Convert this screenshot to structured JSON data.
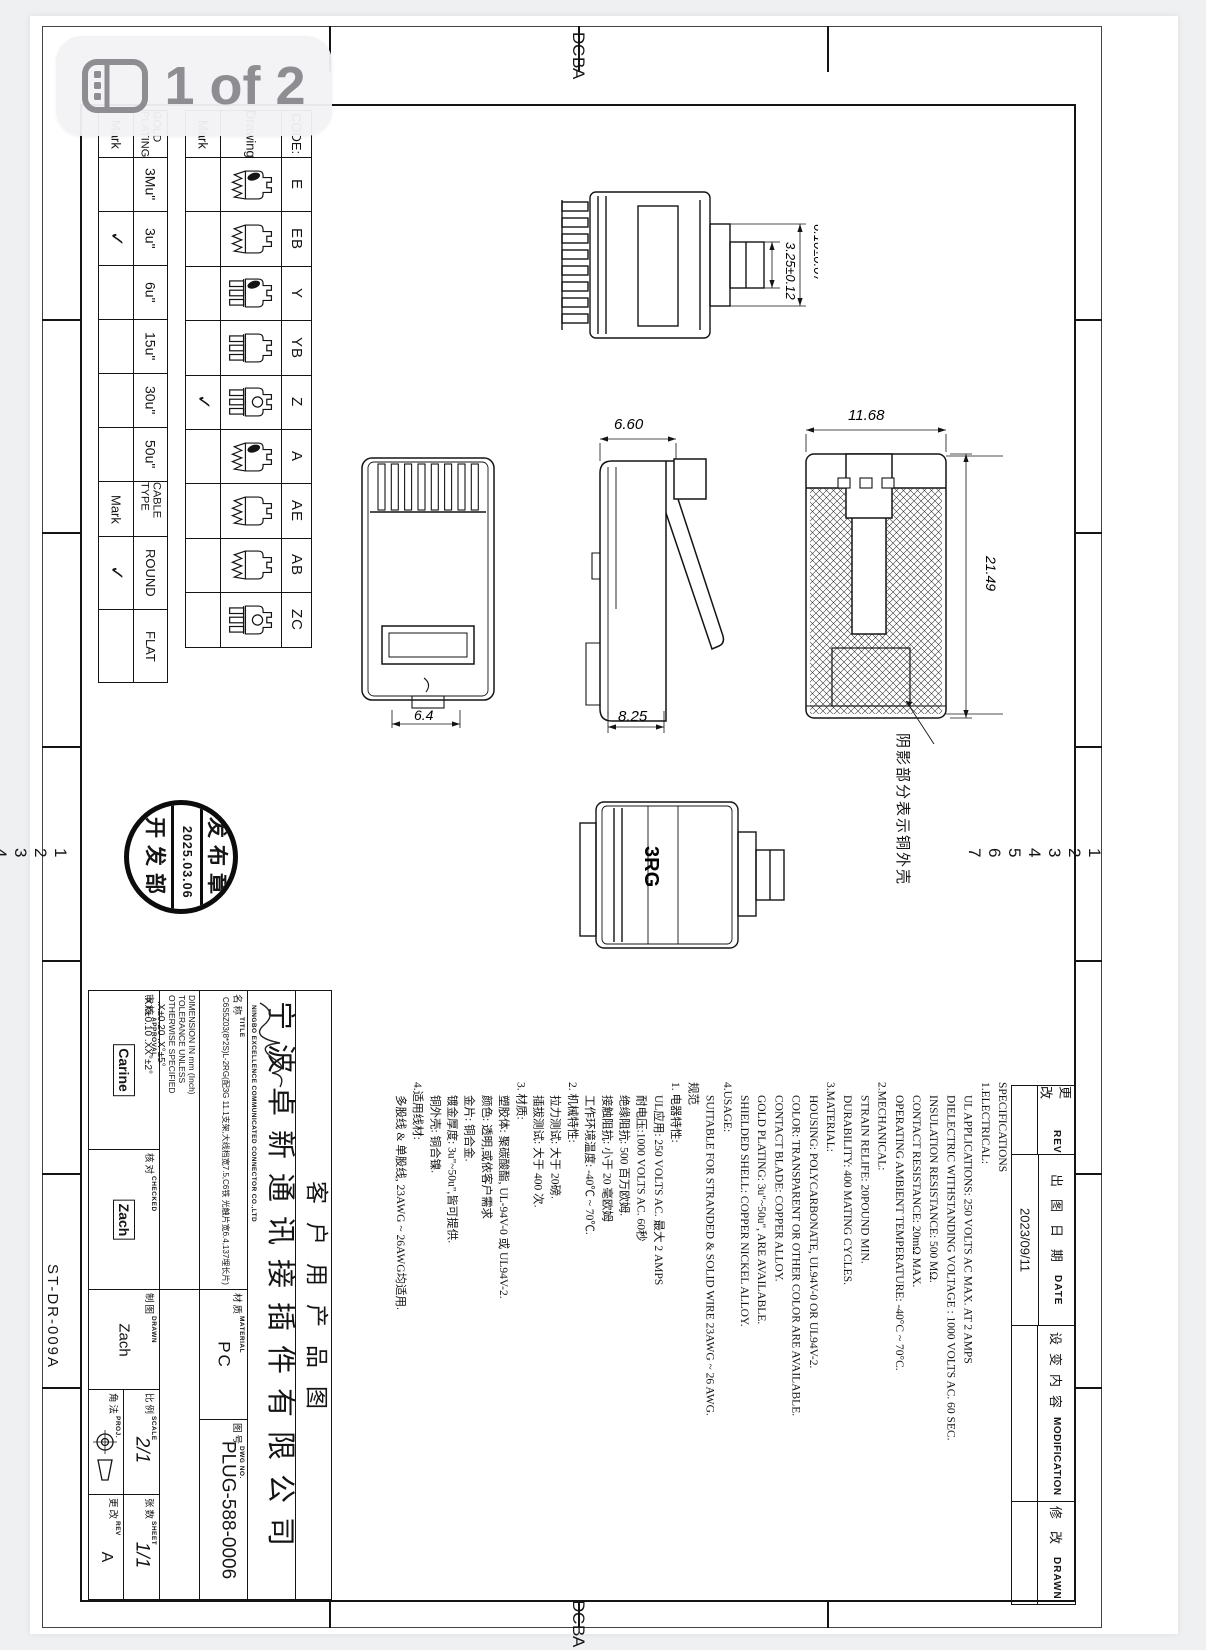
{
  "badge": {
    "label": "1 of 2",
    "icon": "pages-panel-icon"
  },
  "frame": {
    "row_numbers": [
      "1",
      "2",
      "3",
      "4",
      "5",
      "6",
      "7"
    ],
    "col_letters": [
      "D",
      "C",
      "B",
      "A"
    ],
    "form_no": "ST-DR-009A"
  },
  "code_table": {
    "code_header": "CODE:",
    "drawing_header": "Drawing",
    "mark_header": "Mark",
    "rows": [
      {
        "code": "E",
        "mark": "",
        "icon": "zz blob"
      },
      {
        "code": "EB",
        "mark": "",
        "icon": "zz"
      },
      {
        "code": "Y",
        "mark": "",
        "icon": "comb blob"
      },
      {
        "code": "YB",
        "mark": "",
        "icon": "comb"
      },
      {
        "code": "Z",
        "mark": "✓",
        "icon": "comb circle"
      },
      {
        "code": "A",
        "mark": "",
        "icon": "zz blob"
      },
      {
        "code": "AE",
        "mark": "",
        "icon": "zz"
      },
      {
        "code": "AB",
        "mark": "",
        "icon": "zz"
      },
      {
        "code": "ZC",
        "mark": "",
        "icon": "comb circle"
      }
    ]
  },
  "plating_table": {
    "header": "GOLD PLATING",
    "mark_header": "Mark",
    "rows": [
      {
        "label": "3Mu\"",
        "mark": ""
      },
      {
        "label": "3u\"",
        "mark": "✓"
      },
      {
        "label": "6u\"",
        "mark": ""
      },
      {
        "label": "15u\"",
        "mark": ""
      },
      {
        "label": "30u\"",
        "mark": ""
      },
      {
        "label": "50u\"",
        "mark": ""
      }
    ]
  },
  "cable_table": {
    "header": "CABLE TYPE",
    "mark_header": "Mark",
    "rows": [
      {
        "label": "ROUND",
        "mark": "✓"
      },
      {
        "label": "FLAT",
        "mark": ""
      }
    ]
  },
  "views": {
    "dims": {
      "top_small": "3.25±0.12",
      "top_large": "6.10±0.07",
      "side_width": "6.60",
      "side_depth": "8.25",
      "rear_width": "11.68",
      "rear_height": "21.49",
      "front_width": "6.4"
    },
    "note": "阴影部分表示铜外壳",
    "marking": "3RG"
  },
  "stamp": {
    "top": "发布章",
    "date": "2025.03.06",
    "bottom": "开发部"
  },
  "specs": {
    "lines": [
      {
        "t": "SPECIFICATIONS",
        "c": ""
      },
      {
        "t": "1.ELECTRICAL:",
        "c": ""
      },
      {
        "t": "UL APPLICATIONS: 250 VOLTS AC MAX. AT 2 AMPS",
        "c": "i"
      },
      {
        "t": "DIELECTRIC WITHSTANDING VOLTAGE : 1000 VOLTS AC. 60 SEC.",
        "c": "i"
      },
      {
        "t": "INSULATION RESISTANCE: 500 MΩ.",
        "c": "i"
      },
      {
        "t": "CONTACT RESISTANCE: 20mΩ MAX.",
        "c": "i"
      },
      {
        "t": "OPERATING AMBIENT TEMPERATURE: -40°C ~ 70°C.",
        "c": "i"
      },
      {
        "t": "2.MECHANICAL:",
        "c": ""
      },
      {
        "t": "STRAIN RELIFE: 20POUND MIN.",
        "c": "i"
      },
      {
        "t": "DURABILITY: 400 MATING CYCLES.",
        "c": "i"
      },
      {
        "t": "3.MATERIAL:",
        "c": ""
      },
      {
        "t": "HOUSING: POLYCARBONATE, UL94V-0 OR UL94V-2.",
        "c": "i"
      },
      {
        "t": "COLOR: TRANSPARENT OR OTHER COLOR ARE AVAILABLE.",
        "c": "i"
      },
      {
        "t": "CONTACT BLADE: COPPER ALLOY.",
        "c": "i"
      },
      {
        "t": "GOLD PLATING: 3u\"~50u\", ARE AVAILABLE.",
        "c": "i"
      },
      {
        "t": "SHIELDED SHELL: COPPER NICKEL ALLOY.",
        "c": "i"
      },
      {
        "t": "4.USAGE:",
        "c": ""
      },
      {
        "t": "SUITABLE FOR STRANDED & SOLID WIRE 23AWG ~ 26 AWG.",
        "c": "i"
      },
      {
        "t": "规范",
        "c": ""
      },
      {
        "t": "1. 电器特性:",
        "c": ""
      },
      {
        "t": "UL应用: 250 VOLTS AC. 最大 2 AMPS",
        "c": "i"
      },
      {
        "t": "耐电压:1000 VOLTS AC. 60秒",
        "c": "i"
      },
      {
        "t": "绝缘阻抗: 500 百万欧姆.",
        "c": "i"
      },
      {
        "t": "接触阻抗: 小于 20 毫欧姆",
        "c": "i"
      },
      {
        "t": "工作环境温度: -40℃ ~ 70℃.",
        "c": "i"
      },
      {
        "t": "2. 机械特性:",
        "c": ""
      },
      {
        "t": "拉力测试: 大于 20磅.",
        "c": "i"
      },
      {
        "t": "插拔测试: 大于 400 次.",
        "c": "i"
      },
      {
        "t": "3. 材质:",
        "c": ""
      },
      {
        "t": "塑胶体: 聚碳酸酯, UL-94V-0 或 UL94V-2.",
        "c": "i"
      },
      {
        "t": "颜色: 透明,或依客户需求",
        "c": "i"
      },
      {
        "t": "金片: 铜合金.",
        "c": "i"
      },
      {
        "t": "镀金厚度: 3u\"~50u\",皆可提供.",
        "c": "i"
      },
      {
        "t": "铜外壳: 铜合镍.",
        "c": "i"
      },
      {
        "t": "4.适用线材:",
        "c": ""
      },
      {
        "t": "多股线 & 单股线, 23AWG ~ 26AWG均适用.",
        "c": "i"
      }
    ]
  },
  "revision": {
    "rows": [
      {
        "cn": "更改",
        "en": "REV",
        "value": ""
      },
      {
        "cn": "出图日期",
        "en": "DATE",
        "value": "2023/09/11"
      },
      {
        "cn": "设变内容",
        "en": "MODIFICATION",
        "value": ""
      },
      {
        "cn": "修改",
        "en": "DRAWN",
        "value": ""
      }
    ]
  },
  "title_block": {
    "customer": "客户用产品图",
    "company_cn": "宁波卓新通讯接插件有限公司",
    "company_en": "NINGBO EXCELLENCE COMMUNICATED CONNECTOR CO.,LTD",
    "title_cn": "名称",
    "title_en": "TITLE",
    "title_text": "C6S5Z03(8*2S)L-2RG(配3G 11.1支架,大线档宽7.5,C6铁 光触片宽6.4,137埋长片)",
    "material_cn": "材质",
    "material_en": "MATERIAL",
    "material_value": "PC",
    "dwg_cn": "图号",
    "dwg_en": "DWG NO.",
    "dwg_value": "PLUG-588-0006",
    "tol_l1": "DIMENSION IN mm (Inch)",
    "tol_l2": "TOLERANCE UNLESS",
    "tol_l3": "OTHERWISE SPECIFIED",
    "tol_v1": ".X±0.20   .X°±5°",
    "tol_v2": ".XX±0.10   .XX°±2°",
    "approval_cn": "审核",
    "approval_en": "APPROVAL",
    "approval_value": "Carine",
    "checked_cn": "核对",
    "checked_en": "CHECKED",
    "checked_value": "Zach",
    "drawn_cn": "制图",
    "drawn_en": "DRAWN",
    "drawn_value": "Zach",
    "proj_cn": "角法",
    "proj_en": "PROJ.",
    "scale_cn": "比例",
    "scale_en": "SCALE",
    "scale_value": "2/1",
    "rev_cn": "更改",
    "rev_en": "REV",
    "rev_value": "A",
    "sheet_cn": "张数",
    "sheet_en": "SHEET",
    "sheet_value": "1/1"
  }
}
